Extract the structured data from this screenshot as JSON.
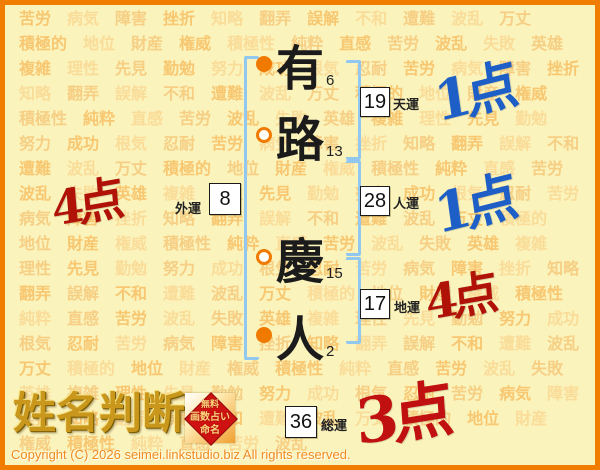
{
  "page_title": "姓名判断",
  "name_chars": [
    {
      "char": "有",
      "strokes": "6",
      "bullet": "filled"
    },
    {
      "char": "路",
      "strokes": "13",
      "bullet": "hollow"
    },
    {
      "char": "慶",
      "strokes": "15",
      "bullet": "hollow"
    },
    {
      "char": "人",
      "strokes": "2",
      "bullet": "filled"
    }
  ],
  "fortunes": [
    {
      "label": "天運",
      "value": "19",
      "score": "1点",
      "score_color": "#1D5FC6"
    },
    {
      "label": "人運",
      "value": "28",
      "score": "1点",
      "score_color": "#1D5FC6"
    },
    {
      "label": "地運",
      "value": "17",
      "score": "4点",
      "score_color": "#B01208"
    },
    {
      "label": "外運",
      "value": "8",
      "score": "4点",
      "score_color": "#B01208"
    },
    {
      "label": "総運",
      "value": "36",
      "score": "3点",
      "score_color": "#C11010"
    }
  ],
  "logo": {
    "title": "姓名判断",
    "seal_lines": [
      "無料",
      "画数占い",
      "命名"
    ]
  },
  "footer": {
    "copyright": "Copyright (C) 2026 seimei.linkstudio.biz All rights reserved."
  },
  "background_words": [
    "苦労",
    "病気",
    "障害",
    "挫折",
    "知略",
    "翻弄",
    "誤解",
    "不和",
    "遭難",
    "波乱",
    "万丈",
    "積極的",
    "地位",
    "財産",
    "権威",
    "積極性",
    "純粋",
    "直感",
    "苦労",
    "波乱",
    "失敗",
    "英雄",
    "複雑",
    "理性",
    "先見",
    "勤勉",
    "努力",
    "成功",
    "根気",
    "忍耐"
  ],
  "colors": {
    "frame": "#F07D00",
    "background": "#FBF3BC",
    "bracket": "#92C8F0",
    "bullet": "#F07A00",
    "blue_score": "#1D5FC6",
    "red_score": "#B01208",
    "seal_red": "#CE1212"
  }
}
